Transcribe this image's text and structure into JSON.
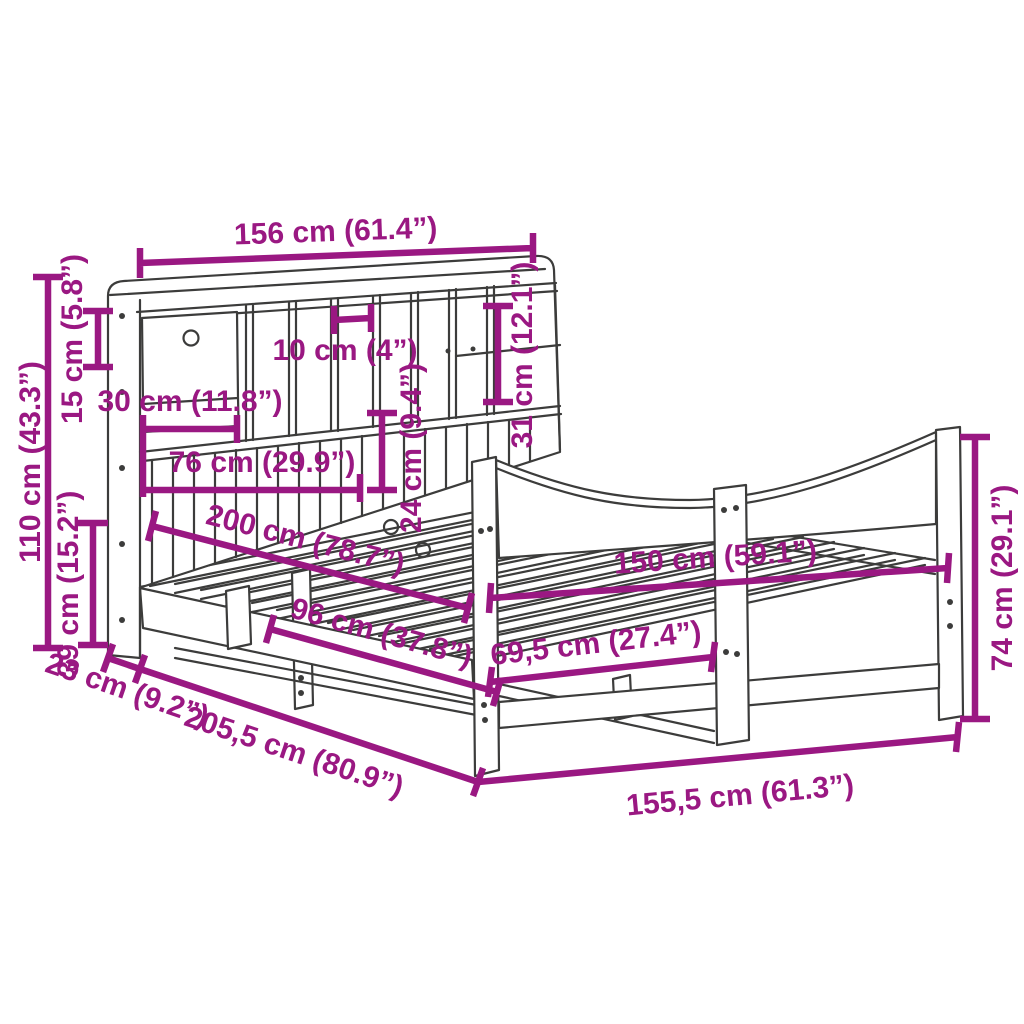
{
  "diagram": {
    "type": "product-dimension-diagram",
    "subject": "bookcase bed frame with storage headboard and curved footboard",
    "colors": {
      "background": "#FFFFFF",
      "line_art": "#3C3C3B",
      "dimension": "#9A1882"
    },
    "dimensions": [
      {
        "id": "headboard-width-top",
        "label": "156 cm (61.4”)"
      },
      {
        "id": "headboard-total-height",
        "label": "110 cm (43.3”)"
      },
      {
        "id": "top-shelf-height",
        "label": "15 cm (5.8”)"
      },
      {
        "id": "base-rail-height",
        "label": "39 cm (15.2”)"
      },
      {
        "id": "drawer-width",
        "label": "30 cm (11.8”)"
      },
      {
        "id": "slat-panel-width",
        "label": "76 cm (29.9”)"
      },
      {
        "id": "cubby-width",
        "label": "10 cm (4”)"
      },
      {
        "id": "shelf-opening-height",
        "label": "31 cm (12.1”)"
      },
      {
        "id": "slat-panel-height",
        "label": "24 cm (9.4”)"
      },
      {
        "id": "bed-length-inner",
        "label": "200 cm (78.7”)"
      },
      {
        "id": "bed-width-inner",
        "label": "150 cm (59.1”)"
      },
      {
        "id": "side-section-length",
        "label": "96 cm (37.8”)"
      },
      {
        "id": "foot-section-length",
        "label": "69,5 cm (27.4”)"
      },
      {
        "id": "headboard-depth",
        "label": "23 cm (9.2”)"
      },
      {
        "id": "bed-length-outer",
        "label": "205,5 cm (80.9”)"
      },
      {
        "id": "bed-width-outer",
        "label": "155,5 cm (61.3”)"
      },
      {
        "id": "footboard-height",
        "label": "74 cm (29.1”)"
      }
    ]
  }
}
